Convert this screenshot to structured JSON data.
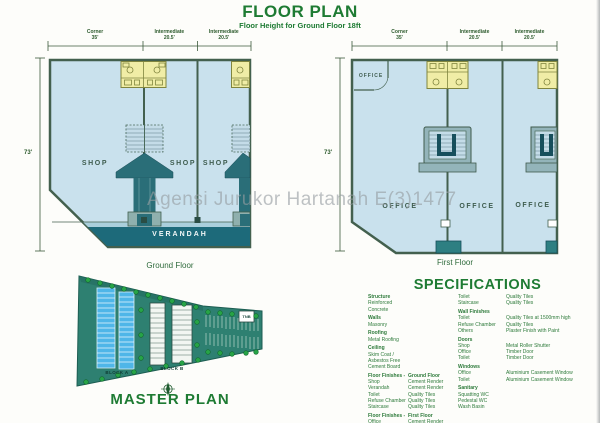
{
  "header": {
    "title": "FLOOR PLAN",
    "subtitle": "Floor Height for Ground Floor 18ft"
  },
  "watermark": "Agensi Jurukor Hartanah E(3)1477",
  "dims_top": [
    {
      "label": "Corner",
      "value": "35'"
    },
    {
      "label": "Intermediate",
      "value": "20.5'"
    },
    {
      "label": "Intermediate",
      "value": "20.5'"
    }
  ],
  "ground_floor": {
    "caption": "Ground Floor",
    "side_dim": "73'",
    "rooms": [
      "SHOP",
      "SHOP",
      "SHOP"
    ],
    "verandah_label": "VERANDAH"
  },
  "first_floor": {
    "caption": "First Floor",
    "side_dim": "73'",
    "corner_room": "OFFICE",
    "rooms": [
      "OFFICE",
      "OFFICE",
      "OFFICE"
    ]
  },
  "master_plan": {
    "title": "MASTER PLAN",
    "block_a": "BLOCK A",
    "block_b": "BLOCK B",
    "tnb": "TNB"
  },
  "specifications": {
    "title": "SPECIFICATIONS",
    "left": [
      {
        "k": "Structure",
        "v": "",
        "cls": "head"
      },
      {
        "k": "Reinforced Concrete",
        "v": "",
        "cls": ""
      },
      {
        "k": "Walls",
        "v": "",
        "cls": "head gap"
      },
      {
        "k": "Masonry",
        "v": "",
        "cls": ""
      },
      {
        "k": "Roofing",
        "v": "",
        "cls": "head gap"
      },
      {
        "k": "Metal Roofing",
        "v": "",
        "cls": ""
      },
      {
        "k": "Ceiling",
        "v": "",
        "cls": "head gap"
      },
      {
        "k": "Skim Coat / Asbestos Free",
        "v": "",
        "cls": ""
      },
      {
        "k": "Cement Board",
        "v": "",
        "cls": ""
      },
      {
        "k": "Floor Finishes -",
        "v": "Ground Floor",
        "cls": "head gap"
      },
      {
        "k": "Shop",
        "v": "Cement Render",
        "cls": ""
      },
      {
        "k": "Verandah",
        "v": "Cement Render",
        "cls": ""
      },
      {
        "k": "Toilet",
        "v": "Quality Tiles",
        "cls": ""
      },
      {
        "k": "Refuse Chamber",
        "v": "Quality Tiles",
        "cls": ""
      },
      {
        "k": "Staircase",
        "v": "Quality Tiles",
        "cls": ""
      },
      {
        "k": "Floor Finishes -",
        "v": "First Floor",
        "cls": "head gap"
      },
      {
        "k": "Office",
        "v": "Cement Render",
        "cls": ""
      },
      {
        "k": "Air Cond Space",
        "v": "Cement Render",
        "cls": ""
      }
    ],
    "right": [
      {
        "k": "Toilet",
        "v": "Quality Tiles",
        "cls": ""
      },
      {
        "k": "Staircase",
        "v": "Quality Tiles",
        "cls": ""
      },
      {
        "k": "Wall Finishes",
        "v": "",
        "cls": "head gap"
      },
      {
        "k": "Toilet",
        "v": "Quality Tiles at 1500mm high",
        "cls": ""
      },
      {
        "k": "Refuse Chamber",
        "v": "Quality Tiles",
        "cls": ""
      },
      {
        "k": "Others",
        "v": "Plaster Finish with Paint",
        "cls": ""
      },
      {
        "k": "Doors",
        "v": "",
        "cls": "head gap"
      },
      {
        "k": "Shop",
        "v": "Metal Roller Shutter",
        "cls": ""
      },
      {
        "k": "Office",
        "v": "Timber Door",
        "cls": ""
      },
      {
        "k": "Toilet",
        "v": "Timber Door",
        "cls": ""
      },
      {
        "k": "Windows",
        "v": "",
        "cls": "head gap"
      },
      {
        "k": "Office",
        "v": "Aluminium Casement Window",
        "cls": ""
      },
      {
        "k": "Toilet",
        "v": "Aluminium Casement Window",
        "cls": ""
      },
      {
        "k": "Sanitary",
        "v": "",
        "cls": "head gap"
      },
      {
        "k": "Squatting WC",
        "v": "",
        "cls": ""
      },
      {
        "k": "Pedestal WC",
        "v": "",
        "cls": ""
      },
      {
        "k": "Wash Basin",
        "v": "",
        "cls": ""
      }
    ]
  },
  "colors": {
    "accent_green": "#1e7b33",
    "plan_fill": "#c9e1ed",
    "toilet_yellow": "#f0eda6",
    "stair_teal": "#2a6e78",
    "verandah_teal": "#1d6a7a",
    "site_teal": "#2e8071",
    "block_blue": "#4fb6e8",
    "watermark_gray": "#969ca2"
  }
}
